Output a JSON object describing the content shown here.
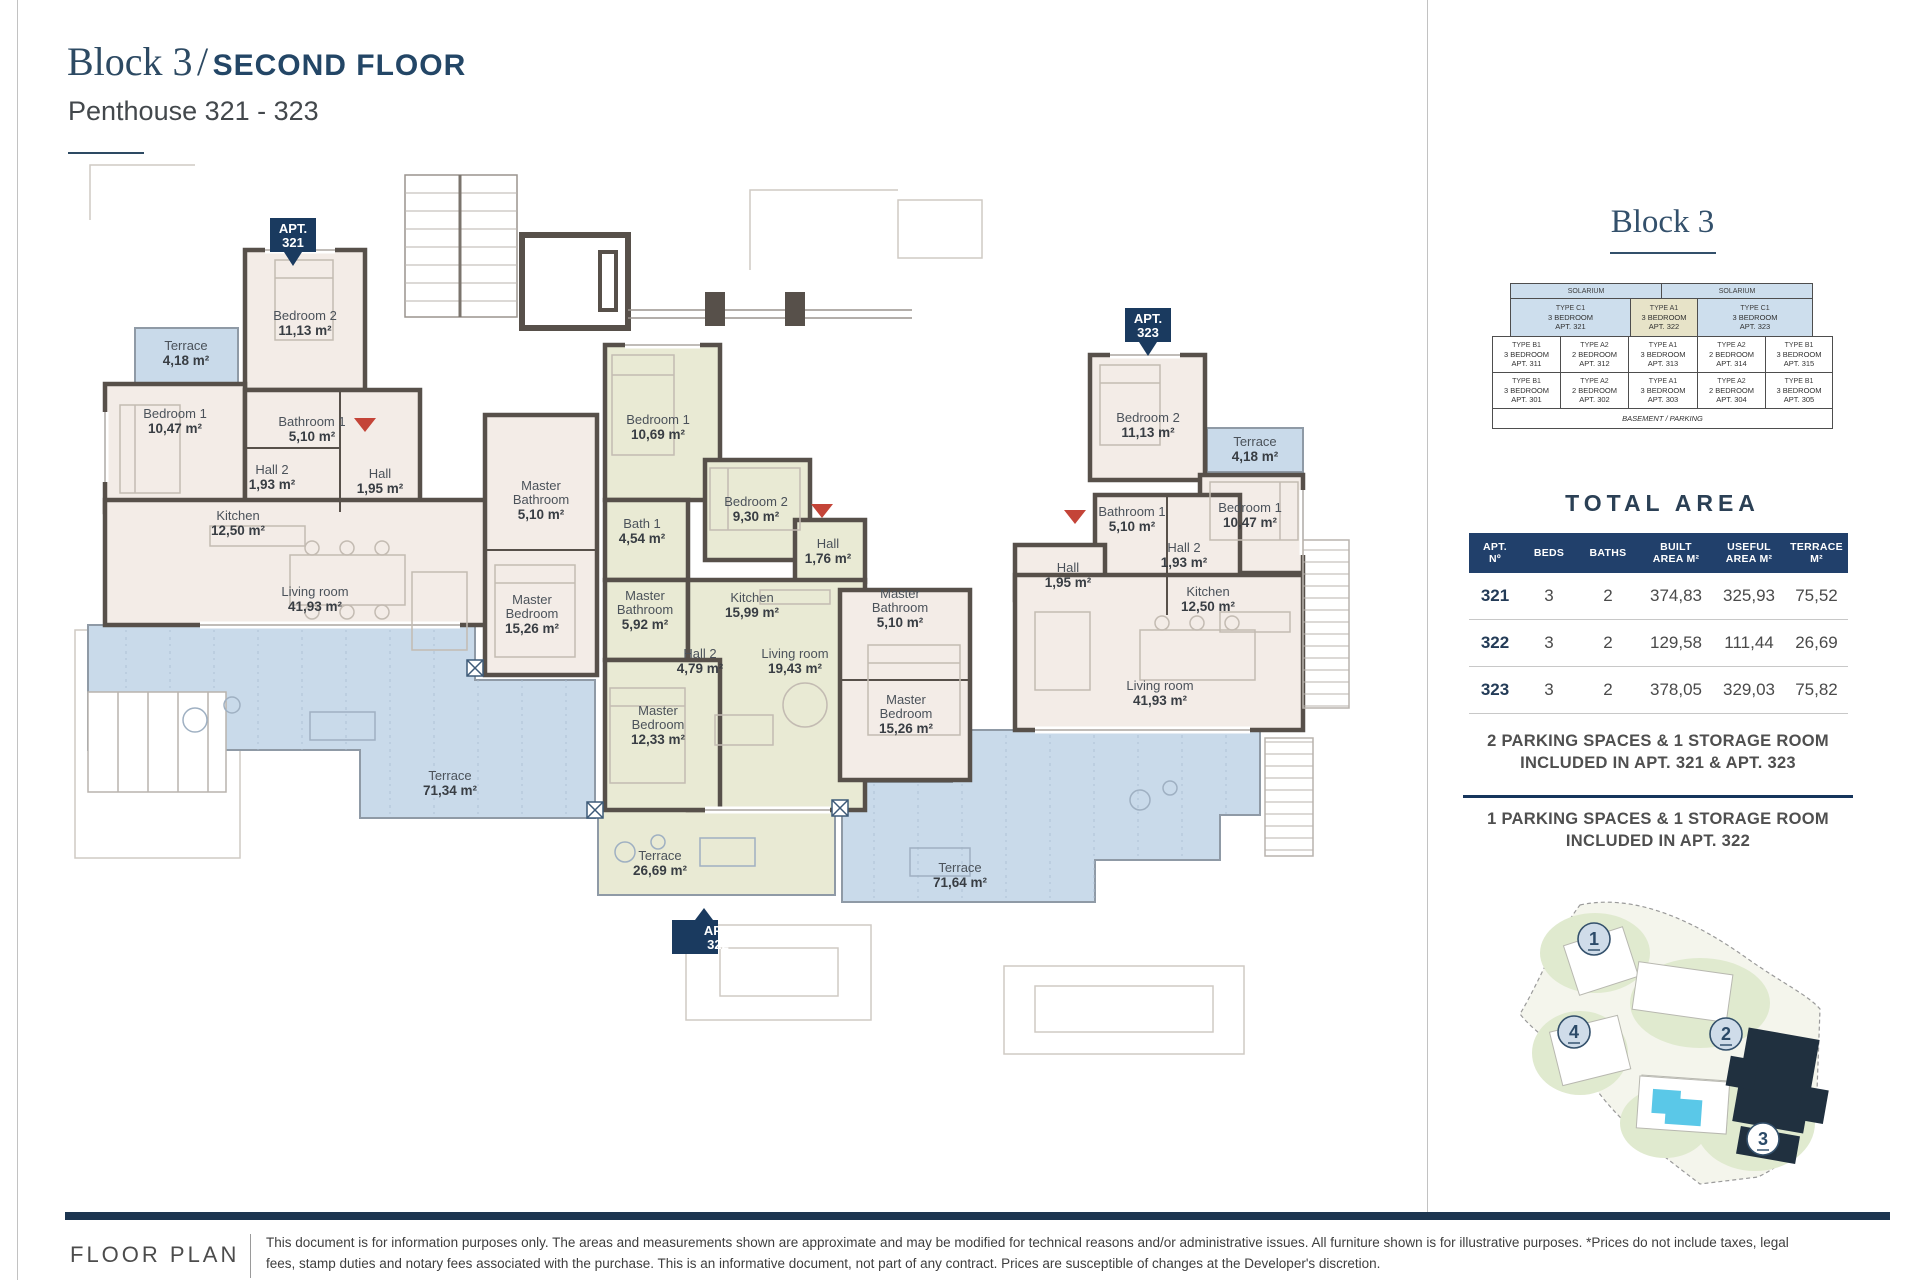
{
  "header": {
    "title_serif": "Block 3",
    "title_sep": "/",
    "title_rest": "SECOND FLOOR",
    "subtitle": "Penthouse 321 - 323"
  },
  "colors": {
    "navy": "#1a3a5f",
    "wall": "#57504a",
    "apartment_pink": "#f3ece7",
    "apartment_green": "#e9ead4",
    "terrace_blue": "#c9daea",
    "highlight_beige": "#e7e3c8",
    "cell_blue": "#cddeed",
    "pool_cyan": "#5ac8e8",
    "entrance_red": "#c44438"
  },
  "plan": {
    "badge_prefix": "APT.",
    "badges": [
      "321",
      "322",
      "323"
    ],
    "apt321": {
      "terrace_small": {
        "n": "Terrace",
        "a": "4,18 m²"
      },
      "bedroom2": {
        "n": "Bedroom 2",
        "a": "11,13 m²"
      },
      "bedroom1": {
        "n": "Bedroom 1",
        "a": "10,47 m²"
      },
      "bathroom1": {
        "n": "Bathroom 1",
        "a": "5,10 m²"
      },
      "hall2": {
        "n": "Hall 2",
        "a": "1,93 m²"
      },
      "hall": {
        "n": "Hall",
        "a": "1,95 m²"
      },
      "kitchen": {
        "n": "Kitchen",
        "a": "12,50 m²"
      },
      "living": {
        "n": "Living room",
        "a": "41,93 m²"
      },
      "master_bath": {
        "n1": "Master",
        "n2": "Bathroom",
        "a": "5,10 m²"
      },
      "master_bed": {
        "n1": "Master",
        "n2": "Bedroom",
        "a": "15,26 m²"
      },
      "terrace": {
        "n": "Terrace",
        "a": "71,34 m²"
      }
    },
    "apt322": {
      "bedroom1": {
        "n": "Bedroom 1",
        "a": "10,69 m²"
      },
      "bath1": {
        "n": "Bath 1",
        "a": "4,54 m²"
      },
      "bedroom2": {
        "n": "Bedroom 2",
        "a": "9,30 m²"
      },
      "hall": {
        "n": "Hall",
        "a": "1,76 m²"
      },
      "kitchen": {
        "n": "Kitchen",
        "a": "15,99 m²"
      },
      "master_bath": {
        "n1": "Master",
        "n2": "Bathroom",
        "a": "5,92 m²"
      },
      "hall2": {
        "n": "Hall 2",
        "a": "4,79 m²"
      },
      "living": {
        "n": "Living room",
        "a": "19,43 m²"
      },
      "master_bed": {
        "n1": "Master",
        "n2": "Bedroom",
        "a": "12,33 m²"
      },
      "terrace": {
        "n": "Terrace",
        "a": "26,69 m²"
      }
    },
    "apt323": {
      "terrace_small": {
        "n": "Terrace",
        "a": "4,18 m²"
      },
      "bedroom2": {
        "n": "Bedroom 2",
        "a": "11,13 m²"
      },
      "bedroom1": {
        "n": "Bedroom 1",
        "a": "10,47 m²"
      },
      "bathroom1": {
        "n": "Bathroom 1",
        "a": "5,10 m²"
      },
      "hall2": {
        "n": "Hall 2",
        "a": "1,93 m²"
      },
      "hall": {
        "n": "Hall",
        "a": "1,95 m²"
      },
      "kitchen": {
        "n": "Kitchen",
        "a": "12,50 m²"
      },
      "living": {
        "n": "Living room",
        "a": "41,93 m²"
      },
      "master_bath": {
        "n1": "Master",
        "n2": "Bathroom",
        "a": "5,10 m²"
      },
      "master_bed": {
        "n1": "Master",
        "n2": "Bedroom",
        "a": "15,26 m²"
      },
      "terrace": {
        "n": "Terrace",
        "a": "71,64 m²"
      }
    }
  },
  "sidebar": {
    "block_title": "Block 3",
    "stack": {
      "solarium": [
        "SOLARIUM",
        "SOLARIUM"
      ],
      "pent": [
        {
          "type": "TYPE C1",
          "beds": "3 BEDROOM",
          "apt": "APT. 321"
        },
        {
          "type": "TYPE A1",
          "beds": "3 BEDROOM",
          "apt": "APT. 322"
        },
        {
          "type": "TYPE C1",
          "beds": "3 BEDROOM",
          "apt": "APT. 323"
        }
      ],
      "row3": [
        {
          "type": "TYPE B1",
          "beds": "3 BEDROOM",
          "apt": "APT. 311"
        },
        {
          "type": "TYPE A2",
          "beds": "2 BEDROOM",
          "apt": "APT. 312"
        },
        {
          "type": "TYPE A1",
          "beds": "3 BEDROOM",
          "apt": "APT. 313"
        },
        {
          "type": "TYPE A2",
          "beds": "2 BEDROOM",
          "apt": "APT. 314"
        },
        {
          "type": "TYPE B1",
          "beds": "3 BEDROOM",
          "apt": "APT. 315"
        }
      ],
      "row2": [
        {
          "type": "TYPE B1",
          "beds": "3 BEDROOM",
          "apt": "APT. 301"
        },
        {
          "type": "TYPE A2",
          "beds": "2 BEDROOM",
          "apt": "APT. 302"
        },
        {
          "type": "TYPE A1",
          "beds": "3 BEDROOM",
          "apt": "APT. 303"
        },
        {
          "type": "TYPE A2",
          "beds": "2 BEDROOM",
          "apt": "APT. 304"
        },
        {
          "type": "TYPE B1",
          "beds": "3 BEDROOM",
          "apt": "APT. 305"
        }
      ],
      "basement": "BASEMENT / PARKING"
    },
    "total_area": {
      "title": "TOTAL AREA",
      "columns": [
        {
          "l1": "APT.",
          "l2": "Nº"
        },
        {
          "l1": "BEDS",
          "l2": ""
        },
        {
          "l1": "BATHS",
          "l2": ""
        },
        {
          "l1": "BUILT",
          "l2": "AREA M²"
        },
        {
          "l1": "USEFUL",
          "l2": "AREA M²"
        },
        {
          "l1": "TERRACE",
          "l2": "M²"
        }
      ],
      "rows": [
        {
          "apt": "321",
          "beds": "3",
          "baths": "2",
          "built": "374,83",
          "useful": "325,93",
          "terrace": "75,52"
        },
        {
          "apt": "322",
          "beds": "3",
          "baths": "2",
          "built": "129,58",
          "useful": "111,44",
          "terrace": "26,69"
        },
        {
          "apt": "323",
          "beds": "3",
          "baths": "2",
          "built": "378,05",
          "useful": "329,03",
          "terrace": "75,82"
        }
      ]
    },
    "parking": {
      "line1": "2 PARKING SPACES & 1 STORAGE ROOM",
      "line2": "INCLUDED IN APT. 321 & APT. 323",
      "line3": "1 PARKING SPACES & 1 STORAGE ROOM",
      "line4": "INCLUDED IN APT. 322"
    },
    "site_map": {
      "markers": [
        "1",
        "2",
        "3",
        "4"
      ]
    }
  },
  "footer": {
    "label": "FLOOR PLAN",
    "line1": "This document is for information purposes only. The areas and measurements shown are approximate and may be modified for technical reasons and/or administrative issues. All furniture shown is for illustrative purposes. *Prices do not include taxes, legal",
    "line2": "fees, stamp duties and notary fees associated with the purchase. This is an informative document, not part of any contract. Prices are susceptible of changes at the Developer's discretion."
  }
}
